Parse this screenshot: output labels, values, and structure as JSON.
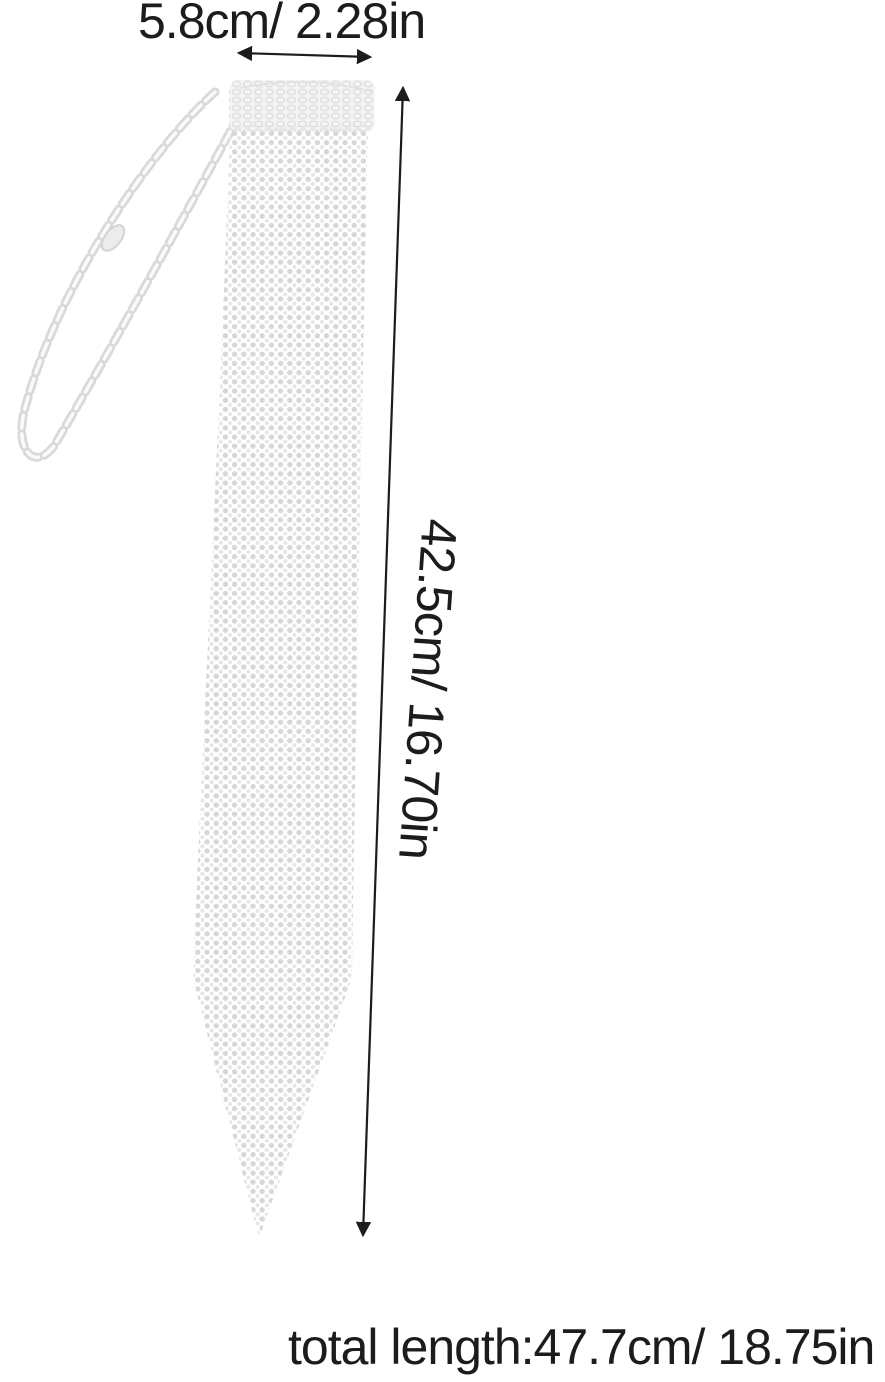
{
  "page": {
    "background_color": "#ffffff",
    "kind": "product-dimension-diagram"
  },
  "annotations": {
    "width_label": "5.8cm/ 2.28in",
    "length_label": "42.5cm/ 16.70in",
    "total_length_label": "total length:47.7cm/ 18.75in",
    "text_color": "#1c1c1c",
    "arrow_color": "#1c1c1c"
  },
  "product": {
    "subject": "rhinestone-mesh-necktie-with-chain",
    "visible_parts": [
      "tie-knot",
      "tie-body",
      "neck-chain",
      "lobster-clasp"
    ],
    "mesh_dot_color": "#d7d7d7",
    "mesh_dot_alt_color": "#e6e6e6",
    "chain_color": "#d9d9d9"
  }
}
